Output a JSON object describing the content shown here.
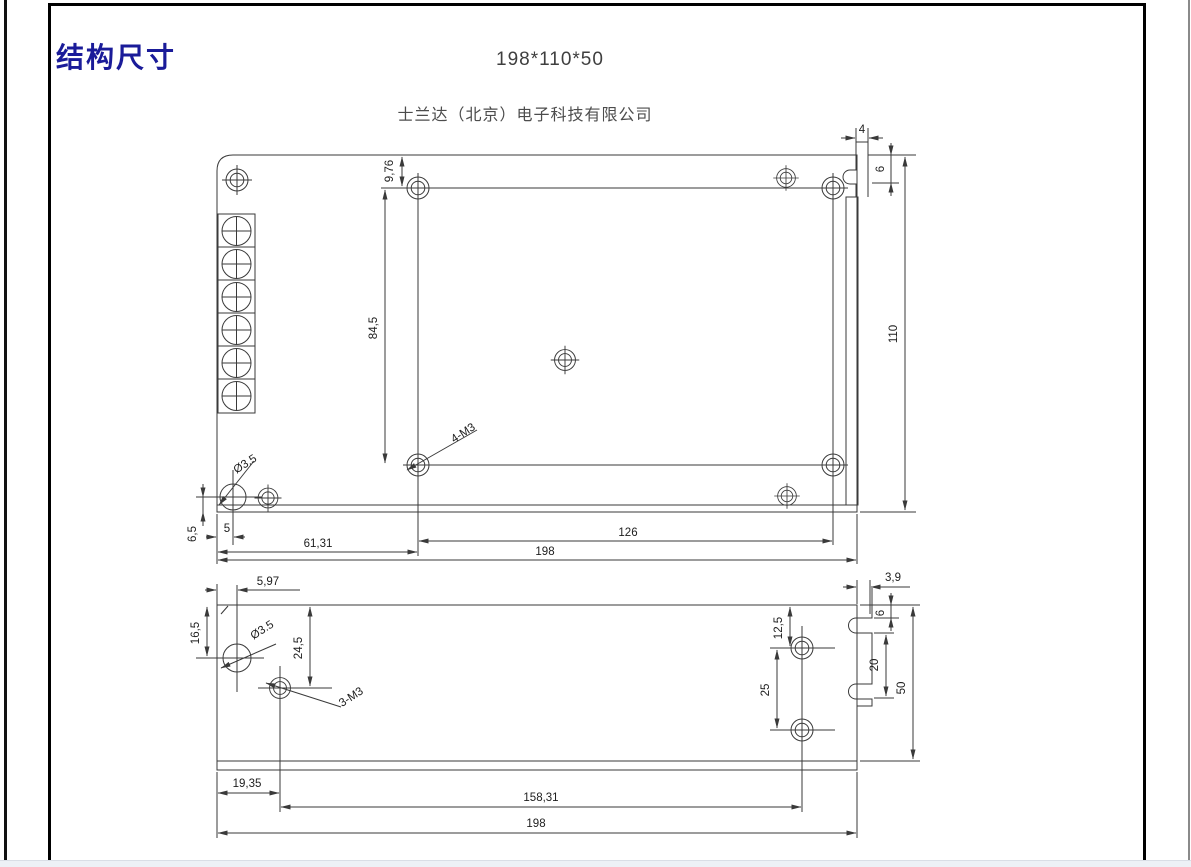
{
  "page": {
    "title": "结构尺寸",
    "size_label": "198*110*50",
    "company": "士兰达（北京）电子科技有限公司",
    "accent_color": "#1a1b99",
    "line_color": "#3a3a3a",
    "footer_strip_color": "#edf1f6"
  },
  "top_view": {
    "labels": {
      "d976": "9,76",
      "d845": "84,5",
      "d110": "110",
      "d4": "4",
      "d6": "6",
      "dia": "Ø3.5",
      "m3": "4-M3",
      "d65": "6,5",
      "d5": "5",
      "d6131": "61,31",
      "d126": "126",
      "d198": "198"
    }
  },
  "bottom_view": {
    "labels": {
      "d597": "5,97",
      "d165": "16,5",
      "d245": "24,5",
      "dia": "Ø3.5",
      "m3": "3-M3",
      "d125": "12,5",
      "d25": "25",
      "d20": "20",
      "d6": "6",
      "d39": "3,9",
      "d50": "50",
      "d1935": "19,35",
      "d15831": "158,31",
      "d198": "198"
    }
  }
}
